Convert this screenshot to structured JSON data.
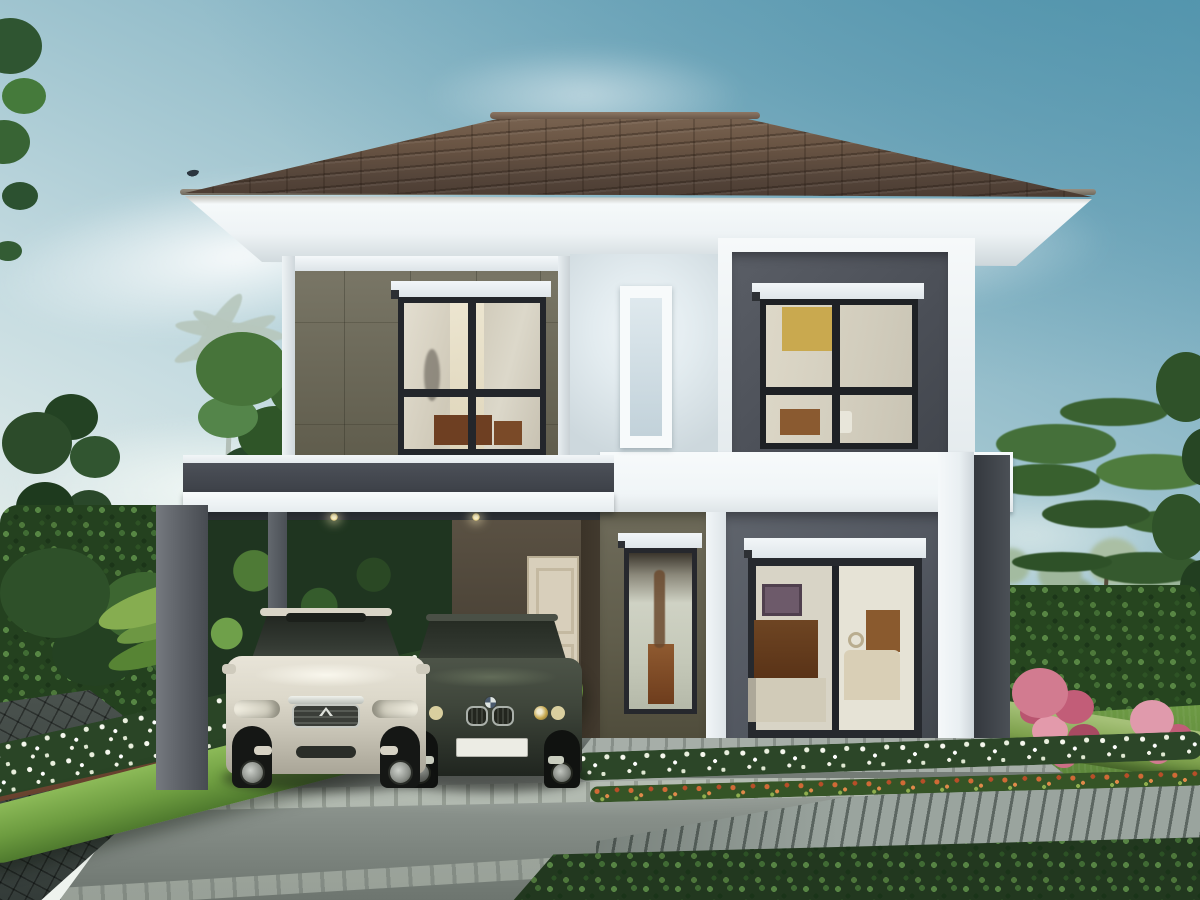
{
  "scene": {
    "kind": "architectural exterior rendering",
    "description": "Modern two-storey house with a brown hipped tile roof, olive and dark grey panelled facade with white trim bands, three upper windows, a tall display window and a sliding glass door on the ground floor, an attached carport with two downlights sheltering a pearl-white sedan and a dark grey sedan, a cream side door, a concrete driveway with paver strips, dark stone pavers, clipped bright hedge strips, white and orange flower rows, pink flowering shrubs, a timber deck, lawns, hedge walls, a pale distant palm and leafy trees under a hazy blue sky with soft clouds",
    "visible_text": [],
    "house": {
      "storeys": 2,
      "roof": {
        "type": "hipped",
        "material": "brown concrete tiles",
        "ridge": "lighter cap row"
      },
      "facade_blocks": [
        "olive panel wall",
        "white centre panel",
        "dark grey framed panel"
      ],
      "upper_windows": 3,
      "ground_openings": [
        "tall narrow display window",
        "two-panel sliding glass door"
      ],
      "roller_shade_boxes": 4,
      "carport": {
        "bays": 2,
        "downlights": 2,
        "posts": 2,
        "side_door": "cream single door"
      }
    },
    "vehicles": [
      {
        "type": "sedan",
        "color": "pearl white",
        "bay": "left",
        "features": [
          "sunroof",
          "chrome grille",
          "fog lights"
        ]
      },
      {
        "type": "sedan",
        "color": "dark grey-green",
        "bay": "right",
        "features": [
          "twin round headlights",
          "kidney grille",
          "blank white license plate"
        ]
      }
    ],
    "landscape": [
      "distant palm tree",
      "hedge walls",
      "white flower rows",
      "orange flower row",
      "pink flower bushes",
      "clipped hedge strip",
      "lawn",
      "timber deck",
      "stone pavers",
      "concrete driveway",
      "corner foliage",
      "small bird in sky"
    ],
    "palette": {
      "sky_top": "#5f9db4",
      "sky_light": "#e2ecea",
      "roof_tile": "#5d4a3c",
      "soffit_white": "#eef3f5",
      "wall_olive": "#6f6c5c",
      "wall_white_panel": "#e2ebef",
      "wall_dark_grey": "#4b4f57",
      "trim_white": "#f3f7f9",
      "carport_slab": "#3d4148",
      "door_cream": "#d8cfbb",
      "glass_warm": "#d6d0c0",
      "accent_yellow_wall": "#c9a94f",
      "car_white": "#ddd9cb",
      "car_dark": "#3f463b",
      "driveway": "#868e88",
      "deck_wood": "#9aa49e",
      "lawn": "#557d36",
      "hedge_dark": "#24411f",
      "hedge_bright": "#6d9c40",
      "flower_white": "#f2f4e8",
      "flower_pink": "#d27b90",
      "flower_orange": "#d06a36"
    }
  }
}
